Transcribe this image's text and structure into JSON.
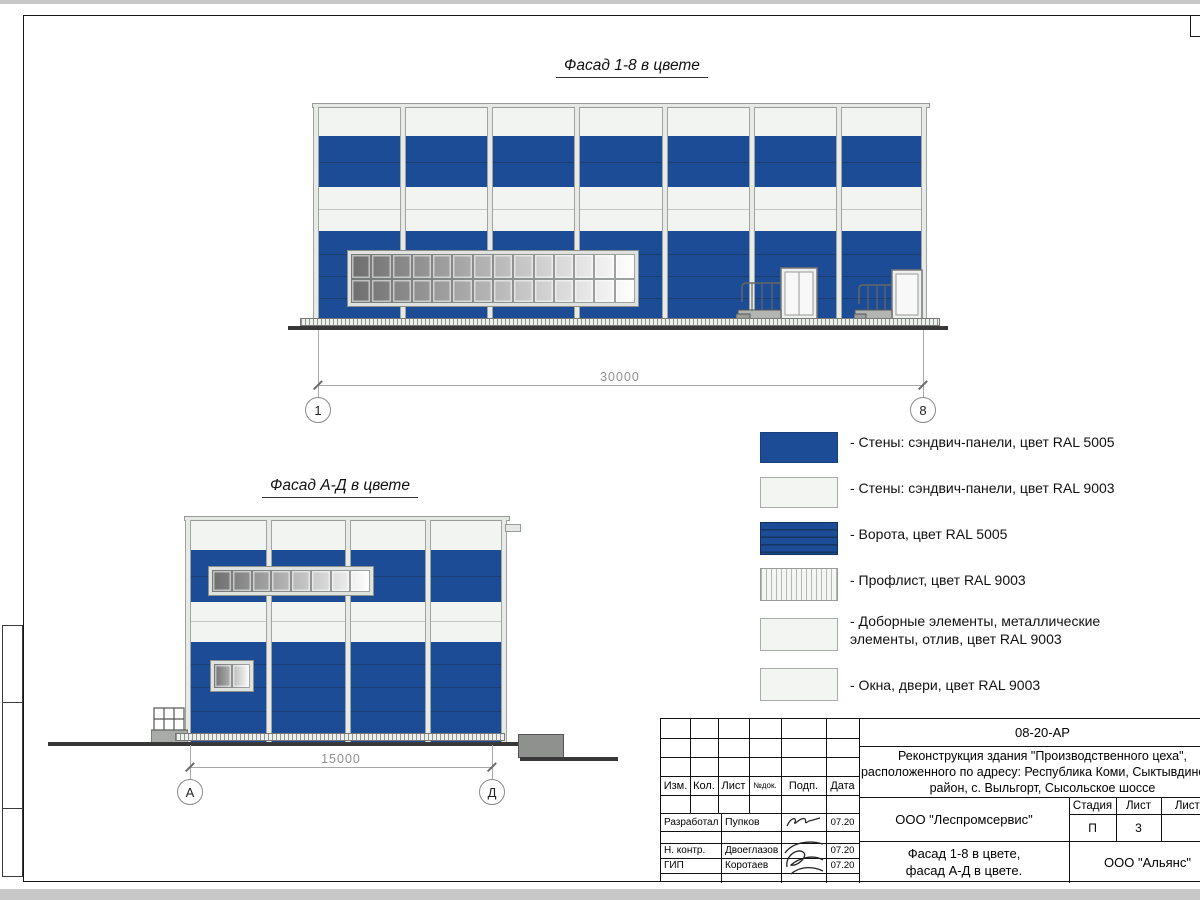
{
  "colors": {
    "wall_blue_ral5005": "#1d4c96",
    "wall_white_ral9003": "#f2f5f1",
    "ground": "#383838"
  },
  "facade1": {
    "title": "Фасад 1-8 в цвете",
    "dimension": "30000",
    "axis_left": "1",
    "axis_right": "8"
  },
  "facade2": {
    "title": "Фасад А-Д в цвете",
    "dimension": "15000",
    "axis_left": "А",
    "axis_right": "Д"
  },
  "legend": {
    "items": [
      {
        "label": "- Стены: сэндвич-панели, цвет RAL 5005"
      },
      {
        "label": "- Стены: сэндвич-панели, цвет RAL 9003"
      },
      {
        "label": "- Ворота, цвет RAL 5005"
      },
      {
        "label": "- Профлист, цвет RAL 9003"
      },
      {
        "label": "- Доборные элементы, металлические\nэлементы, отлив, цвет RAL 9003"
      },
      {
        "label": "- Окна, двери, цвет RAL 9003"
      }
    ]
  },
  "titleblock": {
    "doc_number": "08-20-АР",
    "project_line1": "Реконструкция здания \"Производственного цеха\",",
    "project_line2": "расположенного по адресу: Республика Коми, Сыктывдинский",
    "project_line3": "район, с. Выльгорт, Сысольское шоссе",
    "col_izm": "Изм.",
    "col_kol": "Кол.",
    "col_list": "Лист",
    "col_ndoc": "№док.",
    "col_podp": "Подп.",
    "col_data": "Дата",
    "rows": [
      {
        "role": "Разработал",
        "name": "Пупков",
        "date": "07.20"
      },
      {
        "role": "Н. контр.",
        "name": "Двоеглазов",
        "date": "07.20"
      },
      {
        "role": "ГИП",
        "name": "Коротаев",
        "date": "07.20"
      }
    ],
    "stage_label": "Стадия",
    "sheet_label": "Лист",
    "sheets_label": "Листов",
    "stage_value": "П",
    "sheet_value": "3",
    "company": "ООО \"Леспромсервис\"",
    "title_line1": "Фасад 1-8 в цвете,",
    "title_line2": "фасад А-Д в цвете.",
    "org": "ООО \"Альянс\""
  }
}
